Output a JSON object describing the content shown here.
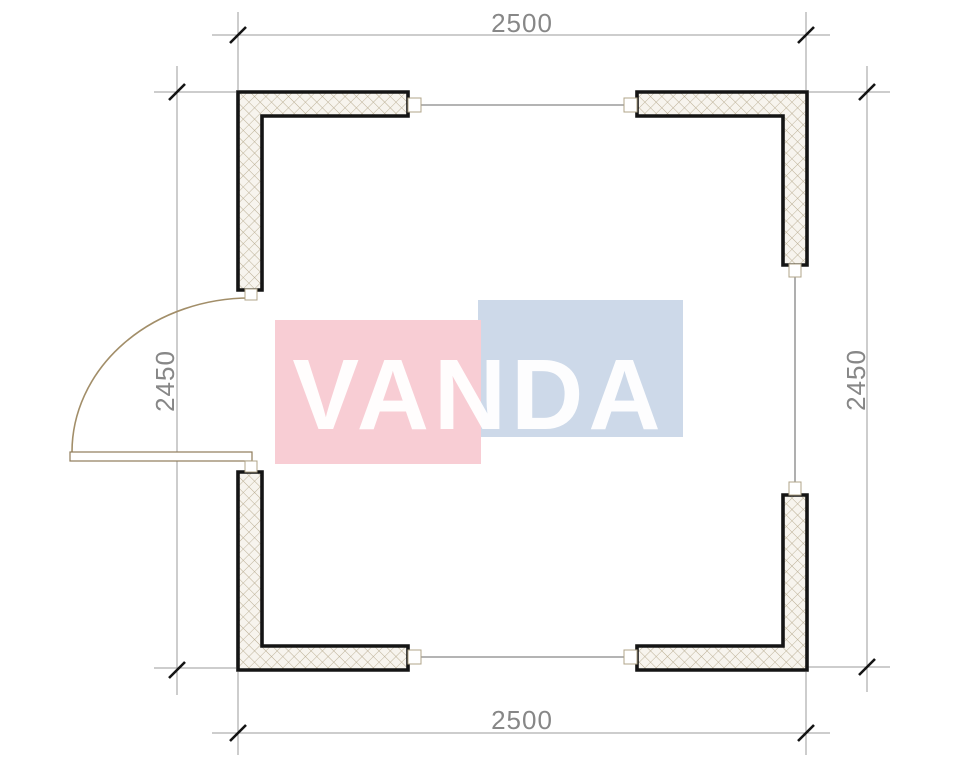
{
  "dimension_labels": {
    "top": "2500",
    "bottom": "2500",
    "left": "2450",
    "right": "2450"
  },
  "watermark": {
    "text": "VANDA",
    "pink_block_color": "#f8cdd4",
    "blue_block_color": "#cdd9e9",
    "text_color": "#ffffff"
  },
  "drawing_colors": {
    "wall_outline": "#141414",
    "wall_hatch_line": "#b9ad92",
    "wall_fill": "#f7f4ee",
    "dimension_line": "#9b9b9b",
    "dimension_tick": "#141414",
    "dimension_text": "#878787",
    "door_line": "#a28e69",
    "connector_line": "#9b9b9b",
    "background": "#ffffff"
  }
}
